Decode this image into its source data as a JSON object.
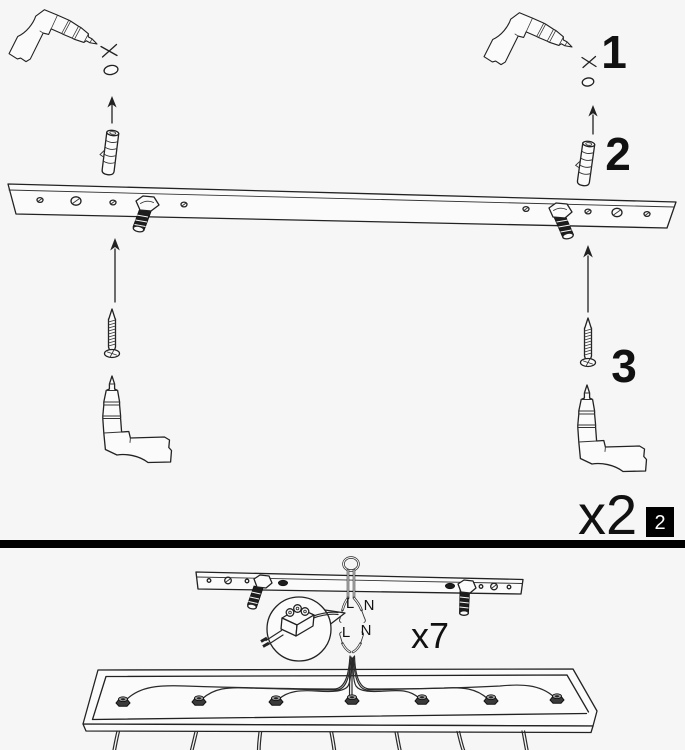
{
  "colors": {
    "background": "#f6f6f6",
    "line": "#222222",
    "divider": "#000000",
    "badge_background": "#000000",
    "badge_text": "#ffffff"
  },
  "step_panel": {
    "callout_1": "1",
    "callout_2": "2",
    "callout_3": "3",
    "quantity_label": "x2",
    "page_badge": "2"
  },
  "wiring_panel": {
    "quantity_label": "x7",
    "ceiling_live": "L",
    "ceiling_neutral": "N",
    "fixture_live": "L",
    "fixture_neutral": "N"
  }
}
